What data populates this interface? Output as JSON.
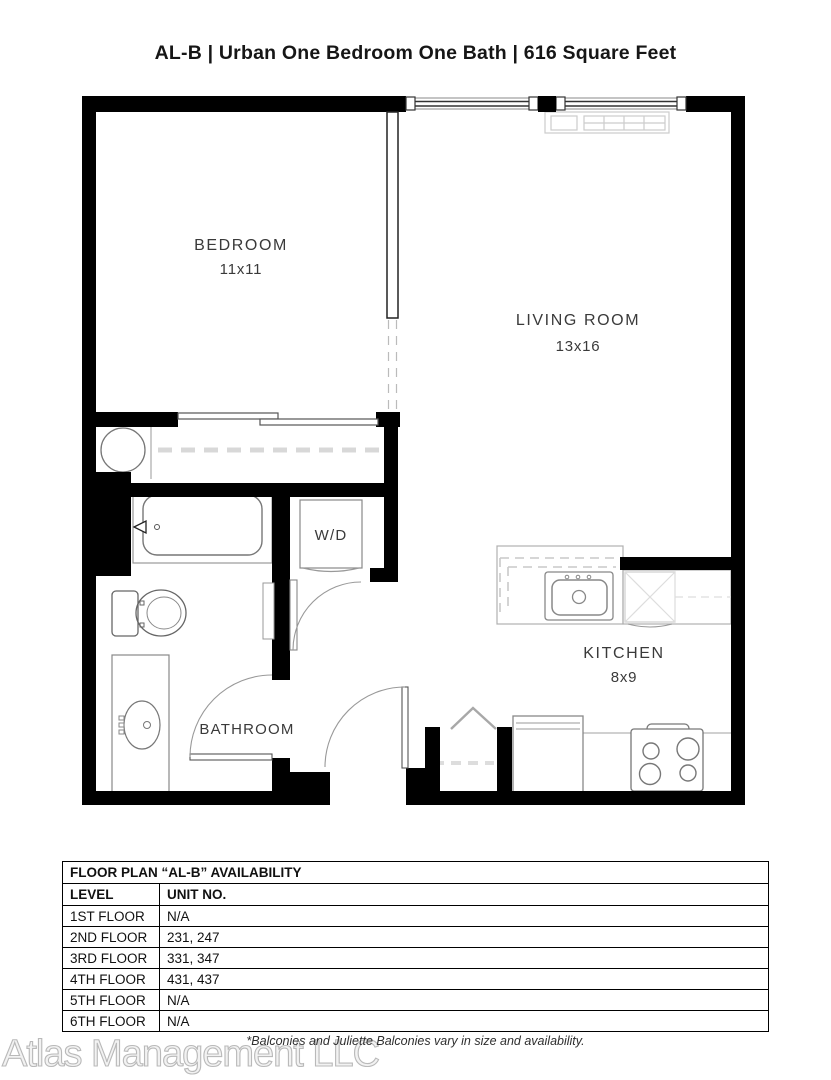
{
  "title": "AL-B | Urban One Bedroom One Bath | 616 Square Feet",
  "floor_plan": {
    "rooms": {
      "bedroom": {
        "name": "BEDROOM",
        "dims": "11x11"
      },
      "living_room": {
        "name": "LIVING ROOM",
        "dims": "13x16"
      },
      "kitchen": {
        "name": "KITCHEN",
        "dims": "8x9"
      },
      "bathroom": {
        "name": "BATHROOM"
      },
      "laundry": {
        "label": "W/D"
      }
    },
    "fixtures": [
      "window-wall",
      "hvac-unit",
      "closet-rod",
      "water-heater",
      "bathtub",
      "toilet",
      "vanity-sink",
      "washer-dryer",
      "kitchen-sink",
      "dishwasher",
      "refrigerator",
      "stove",
      "entry-door",
      "bathroom-door",
      "laundry-door",
      "closet-doors"
    ]
  },
  "availability": {
    "title": "FLOOR PLAN “AL-B” AVAILABILITY",
    "columns": {
      "level": "LEVEL",
      "unit": "UNIT NO."
    },
    "rows": [
      {
        "level": "1ST FLOOR",
        "unit": "N/A"
      },
      {
        "level": "2ND FLOOR",
        "unit": "231, 247"
      },
      {
        "level": "3RD FLOOR",
        "unit": "331, 347"
      },
      {
        "level": "4TH FLOOR",
        "unit": "431, 437"
      },
      {
        "level": "5TH FLOOR",
        "unit": "N/A"
      },
      {
        "level": "6TH FLOOR",
        "unit": "N/A"
      }
    ]
  },
  "footnote": "*Balconies and Juliette Balconies vary in size and availability.",
  "watermark": "Atlas Management LLC",
  "colors": {
    "wall": "#000000",
    "fixture_stroke": "#888888",
    "light_detail": "#cccccc",
    "text": "#3a3a3a"
  }
}
